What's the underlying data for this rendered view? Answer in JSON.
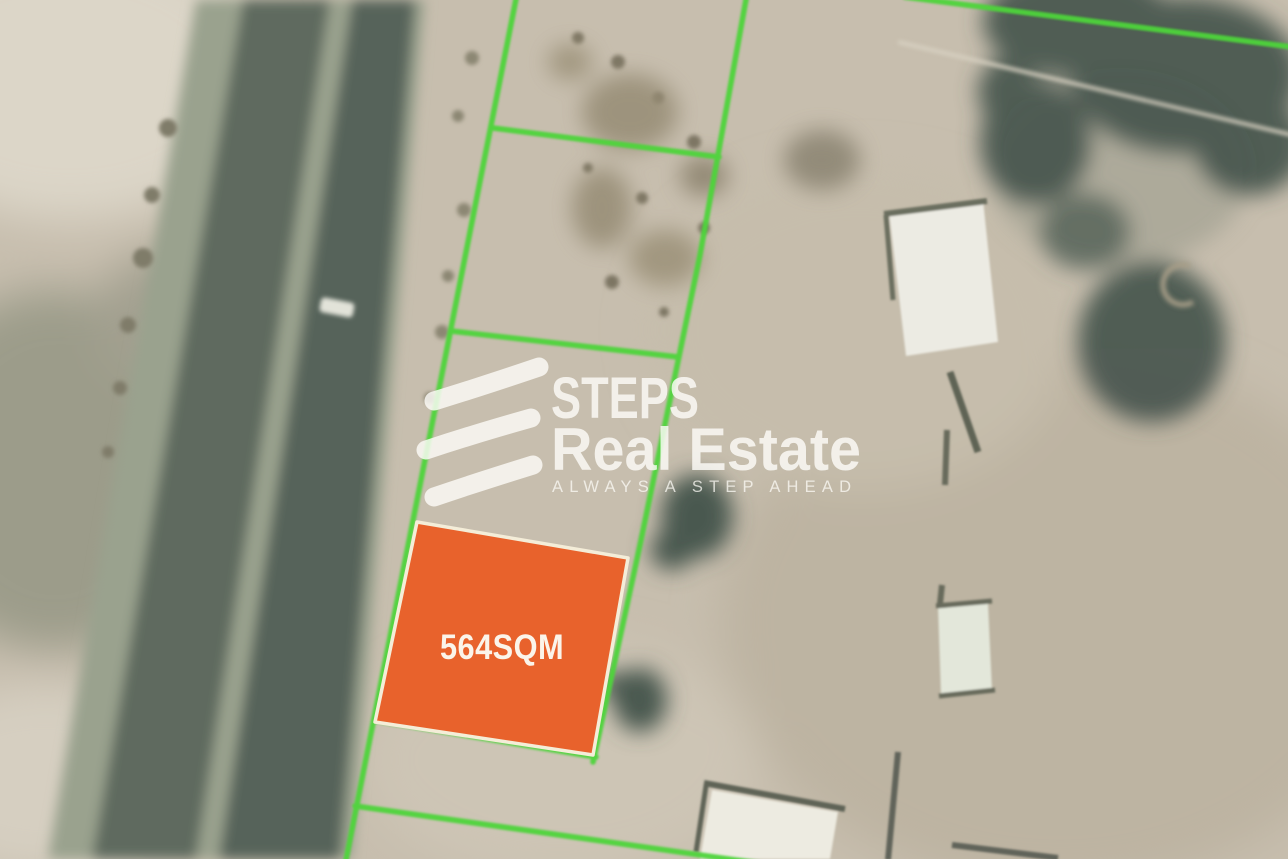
{
  "map": {
    "kind": "satellite-plot-map",
    "plot": {
      "area_label": "564SQM",
      "fill_color": "#E8622C",
      "border_color": "#F4EDD8",
      "label_color": "#FBF4EA"
    },
    "boundary": {
      "line_color": "#4ED43A"
    },
    "palette": {
      "sand": "#C7BEAE",
      "road_asphalt": "#5E6A5E",
      "road_median": "#9AA28E",
      "trees": "#46554E"
    }
  },
  "watermark": {
    "icon": "steps-logo-icon",
    "brand_name": "STEPS",
    "brand_suffix": "Real Estate",
    "tagline": "ALWAYS A STEP AHEAD",
    "text_color": "#FDFCF8"
  }
}
